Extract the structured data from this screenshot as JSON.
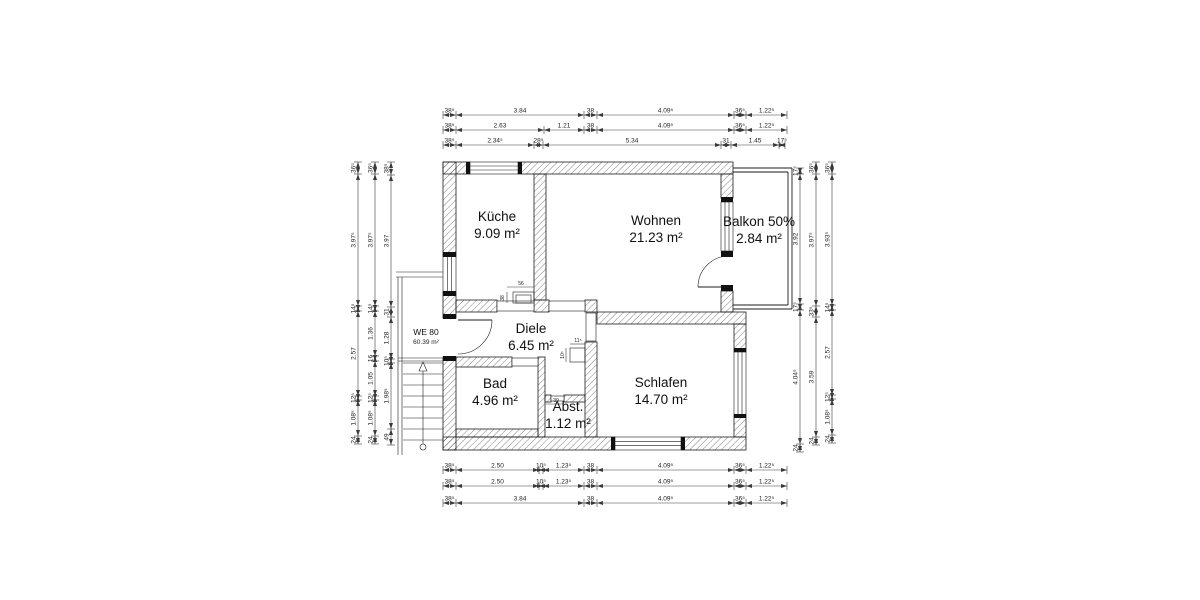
{
  "drawing_title": "Grundriss Wohnung WE 80",
  "unit_label": {
    "name": "WE 80",
    "area": "60.39 m²",
    "x": 426,
    "y": 335
  },
  "rooms": [
    {
      "id": "kueche",
      "name": "Küche",
      "area": "9.09 m²",
      "x": 497,
      "y": 221
    },
    {
      "id": "wohnen",
      "name": "Wohnen",
      "area": "21.23 m²",
      "x": 656,
      "y": 225
    },
    {
      "id": "balkon",
      "name": "Balkon 50%",
      "area": "2.84 m²",
      "x": 759,
      "y": 226
    },
    {
      "id": "diele",
      "name": "Diele",
      "area": "6.45 m²",
      "x": 531,
      "y": 333
    },
    {
      "id": "bad",
      "name": "Bad",
      "area": "4.96 m²",
      "x": 495,
      "y": 388
    },
    {
      "id": "abst",
      "name": "Abst.",
      "area": "1.12 m²",
      "x": 568,
      "y": 411
    },
    {
      "id": "schlafen",
      "name": "Schlafen",
      "area": "14.70 m²",
      "x": 661,
      "y": 387
    }
  ],
  "dims": {
    "top": [
      {
        "y": 115,
        "b": [
          443,
          456,
          584,
          597,
          734,
          746,
          787
        ],
        "labels": [
          "38⁵",
          "3.84",
          "38",
          "4.09⁵",
          "36⁵",
          "1.22⁵"
        ]
      },
      {
        "y": 130,
        "b": [
          443,
          456,
          544,
          584,
          597,
          734,
          746,
          787
        ],
        "labels": [
          "38⁵",
          "2.63",
          "1.21",
          "38",
          "4.09⁵",
          "36⁵",
          "1.22⁵"
        ]
      },
      {
        "y": 145,
        "b": [
          443,
          456,
          534,
          543,
          721,
          731,
          779,
          785
        ],
        "labels": [
          "38⁵",
          "2.34⁵",
          "28⁵",
          "5.34",
          "31",
          "1.45",
          "17⁵"
        ]
      }
    ],
    "bottom": [
      {
        "y": 470,
        "b": [
          443,
          456,
          539,
          543,
          584,
          597,
          734,
          746,
          787
        ],
        "labels": [
          "38⁵",
          "2.50",
          "10⁵",
          "1.23⁵",
          "38",
          "4.09⁵",
          "36⁵",
          "1.22⁵"
        ]
      },
      {
        "y": 486,
        "b": [
          443,
          456,
          539,
          543,
          584,
          597,
          734,
          746,
          787
        ],
        "labels": [
          "38⁵",
          "2.50",
          "10⁵",
          "1.23⁵",
          "38",
          "4.09⁵",
          "36⁵",
          "1.22⁵"
        ]
      },
      {
        "y": 503,
        "b": [
          443,
          456,
          584,
          597,
          734,
          746,
          787
        ],
        "labels": [
          "38⁵",
          "3.84",
          "38",
          "4.09⁵",
          "36⁵",
          "1.22⁵"
        ]
      }
    ],
    "left": [
      {
        "x": 358,
        "b": [
          162,
          174,
          306,
          311,
          396,
          400,
          436,
          444
        ],
        "labels": [
          "36⁵",
          "3.97⁵",
          "14⁵",
          "2.57",
          "12⁵",
          "1.08⁵",
          "24"
        ]
      },
      {
        "x": 375,
        "b": [
          162,
          174,
          306,
          311,
          356,
          361,
          396,
          400,
          436,
          444
        ],
        "labels": [
          "36⁵",
          "3.97⁵",
          "14⁵",
          "1.36",
          "16",
          "1.05",
          "12⁵",
          "1.08⁵",
          "24"
        ]
      },
      {
        "x": 391,
        "b": [
          162,
          175,
          307,
          317,
          359,
          363,
          429,
          445
        ],
        "labels": [
          "38⁵",
          "3.97",
          "31",
          "1.28",
          "10⁵",
          "1.98⁵",
          "49"
        ]
      }
    ],
    "right": [
      {
        "x": 800,
        "b": [
          168,
          174,
          304,
          310,
          444,
          452
        ],
        "labels": [
          "17⁵",
          "3.92",
          "17⁵",
          "4.04⁵",
          "24"
        ]
      },
      {
        "x": 816,
        "b": [
          162,
          174,
          306,
          317,
          437,
          445
        ],
        "labels": [
          "36⁵",
          "3.97⁵",
          "33⁵",
          "3.59",
          "24"
        ]
      },
      {
        "x": 832,
        "b": [
          162,
          174,
          305,
          310,
          395,
          399,
          435,
          443
        ],
        "labels": [
          "36⁵",
          "3.93⁵",
          "14⁵",
          "2.57",
          "12⁵",
          "1.08⁵",
          "24"
        ]
      }
    ]
  },
  "tiny_dims": [
    {
      "label": "56",
      "x": 521,
      "y": 285,
      "rot": 0
    },
    {
      "label": "38",
      "x": 504,
      "y": 298,
      "rot": -90
    },
    {
      "label": "11⁵",
      "x": 578,
      "y": 342,
      "rot": 0
    },
    {
      "label": "10⁵",
      "x": 564,
      "y": 355,
      "rot": -90
    },
    {
      "label": "39",
      "x": 556,
      "y": 402,
      "rot": 0
    }
  ],
  "geometry": {
    "walls": [
      [
        443,
        162,
        27,
        12
      ],
      [
        518,
        162,
        215,
        12
      ],
      [
        443,
        162,
        13,
        94
      ],
      [
        443,
        292,
        13,
        26
      ],
      [
        443,
        357,
        13,
        93
      ],
      [
        721,
        174,
        12,
        24
      ],
      [
        721,
        291,
        12,
        21
      ],
      [
        534,
        174,
        12,
        126
      ],
      [
        456,
        300,
        41,
        12
      ],
      [
        534,
        300,
        15,
        12
      ],
      [
        585,
        300,
        12,
        12
      ],
      [
        585,
        342,
        12,
        95
      ],
      [
        597,
        312,
        149,
        12
      ],
      [
        443,
        437,
        172,
        13
      ],
      [
        681,
        437,
        65,
        13
      ],
      [
        734,
        324,
        12,
        28
      ],
      [
        734,
        415,
        12,
        22
      ],
      [
        456,
        357,
        56,
        10
      ],
      [
        538,
        357,
        7,
        80
      ],
      [
        545,
        395,
        6,
        7
      ],
      [
        564,
        395,
        21,
        7
      ],
      [
        456,
        429,
        82,
        8
      ]
    ],
    "windows": [
      {
        "r": [
          470,
          162,
          48,
          12
        ],
        "dir": "h"
      },
      {
        "r": [
          443,
          256,
          13,
          36
        ],
        "dir": "v"
      },
      {
        "r": [
          615,
          437,
          66,
          13
        ],
        "dir": "h"
      },
      {
        "r": [
          734,
          352,
          12,
          63
        ],
        "dir": "v"
      },
      {
        "r": [
          721,
          202,
          12,
          49
        ],
        "dir": "v"
      }
    ],
    "thresholds": [
      [
        497,
        301,
        37,
        10
      ],
      [
        549,
        301,
        36,
        10
      ],
      [
        586,
        313,
        10,
        28
      ],
      [
        512,
        358,
        26,
        8
      ],
      [
        551,
        396,
        13,
        5
      ]
    ],
    "blocks": [
      [
        466,
        162,
        4,
        12
      ],
      [
        518,
        162,
        4,
        12
      ],
      [
        443,
        252,
        13,
        5
      ],
      [
        443,
        291,
        13,
        5
      ],
      [
        443,
        314,
        13,
        5
      ],
      [
        443,
        356,
        13,
        5
      ],
      [
        611,
        437,
        4,
        13
      ],
      [
        681,
        437,
        4,
        13
      ],
      [
        734,
        348,
        12,
        4
      ],
      [
        734,
        414,
        12,
        4
      ],
      [
        721,
        197,
        12,
        5
      ],
      [
        721,
        251,
        12,
        6
      ],
      [
        721,
        285,
        12,
        6
      ]
    ],
    "doors": [
      {
        "leaf": [
          458,
          320,
          492,
          320
        ],
        "arc": "M492,320 A34,34 0 0 1 458,354"
      },
      {
        "leaf": [
          729,
          287,
          698,
          287
        ],
        "arc": "M698,287 A31,31 0 0 1 729,256"
      }
    ],
    "balcony_lines": [
      [
        733,
        168,
        792,
        168
      ],
      [
        792,
        168,
        792,
        309
      ],
      [
        733,
        309,
        792,
        309
      ],
      [
        733,
        172,
        788,
        172
      ],
      [
        788,
        172,
        788,
        305
      ],
      [
        733,
        305,
        788,
        305
      ]
    ],
    "stairs": {
      "tread_x1": 403,
      "tread_x2": 443,
      "tread_ys": [
        363,
        374,
        385,
        396,
        407,
        418,
        429,
        440
      ],
      "rails": [
        [
          396,
          272,
          443,
          272
        ],
        [
          396,
          277,
          443,
          277
        ],
        [
          398,
          277,
          398,
          455
        ],
        [
          402,
          277,
          402,
          455
        ],
        [
          398,
          358,
          443,
          358
        ],
        [
          398,
          361,
          443,
          361
        ]
      ],
      "walkline": [
        423,
        371,
        423,
        444
      ],
      "circle": [
        423,
        447,
        3
      ],
      "triangle": [
        [
          423,
          362
        ],
        [
          419,
          371
        ],
        [
          427,
          371
        ]
      ]
    },
    "misc_rects": [
      [
        513,
        292,
        21,
        11
      ],
      [
        516,
        295,
        15,
        8
      ],
      [
        570,
        348,
        15,
        14
      ]
    ],
    "misc_lines": [
      [
        507,
        287,
        534,
        287
      ],
      [
        507,
        292,
        507,
        303
      ],
      [
        570,
        344,
        585,
        344
      ],
      [
        566,
        348,
        566,
        362
      ],
      [
        546,
        404,
        564,
        404
      ]
    ]
  }
}
